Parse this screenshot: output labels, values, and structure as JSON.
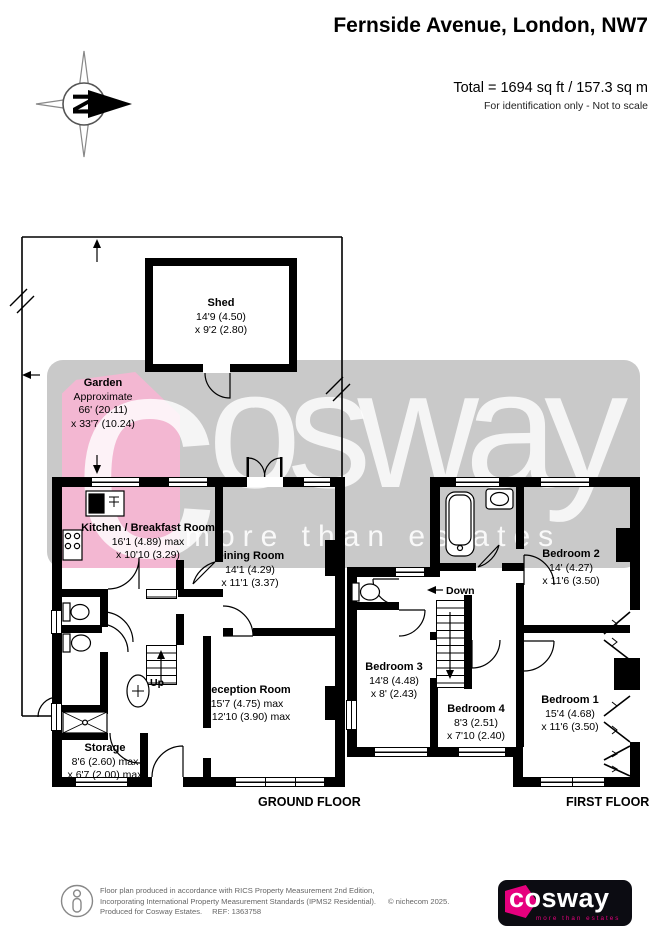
{
  "header": {
    "title": "Fernside Avenue, London, NW7",
    "total": "Total = 1694 sq ft / 157.3 sq m",
    "note": "For identification only - Not to scale"
  },
  "compass": {
    "letter": "N"
  },
  "garden": {
    "name": "Garden",
    "l1": "Approximate",
    "l2": "66' (20.11)",
    "l3": "x 33'7 (10.24)"
  },
  "shed": {
    "name": "Shed",
    "l1": "14'9 (4.50)",
    "l2": "x 9'2 (2.80)"
  },
  "ground": {
    "label": "GROUND FLOOR",
    "up": "Up",
    "kitchen": {
      "name": "Kitchen / Breakfast Room",
      "l1": "16'1 (4.89) max",
      "l2": "x 10'10 (3.29)"
    },
    "dining": {
      "name": "Dining Room",
      "l1": "14'1 (4.29)",
      "l2": "x 11'1 (3.37)"
    },
    "reception": {
      "name": "Reception Room",
      "l1": "15'7 (4.75) max",
      "l2": "x 12'10 (3.90) max"
    },
    "storage": {
      "name": "Storage",
      "l1": "8'6 (2.60) max",
      "l2": "x 6'7 (2.00) max"
    }
  },
  "first": {
    "label": "FIRST FLOOR",
    "down": "Down",
    "bed1": {
      "name": "Bedroom 1",
      "l1": "15'4 (4.68)",
      "l2": "x 11'6 (3.50)"
    },
    "bed2": {
      "name": "Bedroom 2",
      "l1": "14' (4.27)",
      "l2": "x 11'6 (3.50)"
    },
    "bed3": {
      "name": "Bedroom 3",
      "l1": "14'8 (4.48)",
      "l2": "x 8' (2.43)"
    },
    "bed4": {
      "name": "Bedroom 4",
      "l1": "8'3 (2.51)",
      "l2": "x 7'10 (2.40)"
    }
  },
  "watermark": {
    "c": "c",
    "rest": "osway",
    "tagline": "more than estates"
  },
  "footer": {
    "line1": "Floor plan produced in accordance with RICS Property Measurement 2nd Edition,",
    "line2": "Incorporating International Property Measurement Standards (IPMS2 Residential).",
    "copyright": "© nichecom 2025.",
    "line3": "Produced for Cosway Estates.",
    "ref": "REF: 1363758"
  },
  "logo": {
    "word": "cosway",
    "tagline": "more than estates"
  },
  "colors": {
    "wall": "#000000",
    "band_gray": "#c9c9c9",
    "soft_pink": "#f3b7d2",
    "magenta": "#e6007e"
  }
}
